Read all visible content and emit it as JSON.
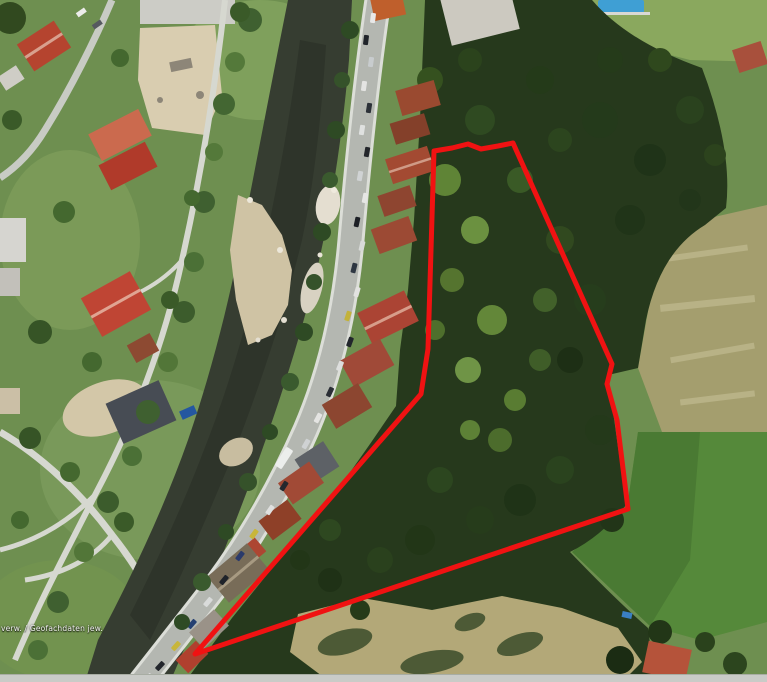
{
  "map": {
    "kind": "aerial-satellite-imagery",
    "attribution": "verw. / Geofachdaten jew.",
    "annotation": {
      "label": "selected-parcel-outline",
      "color": "#f01212",
      "stroke_width": 5,
      "points": "434,151 452,148 468,144 481,149 498,146 513,143 612,364 607,384 617,420 628,509 195,654 421,394 428,349"
    },
    "palette": {
      "forest": "#26391c",
      "park_green": "#6e8f50",
      "meadow_dry": "#a49e6e",
      "meadow_bright": "#55893a",
      "river": "#363d31",
      "road": "#b4b7b1",
      "roof_red": "#a84836",
      "gravel": "#cfc3a4",
      "pool_blue": "#3f9fd4"
    }
  }
}
